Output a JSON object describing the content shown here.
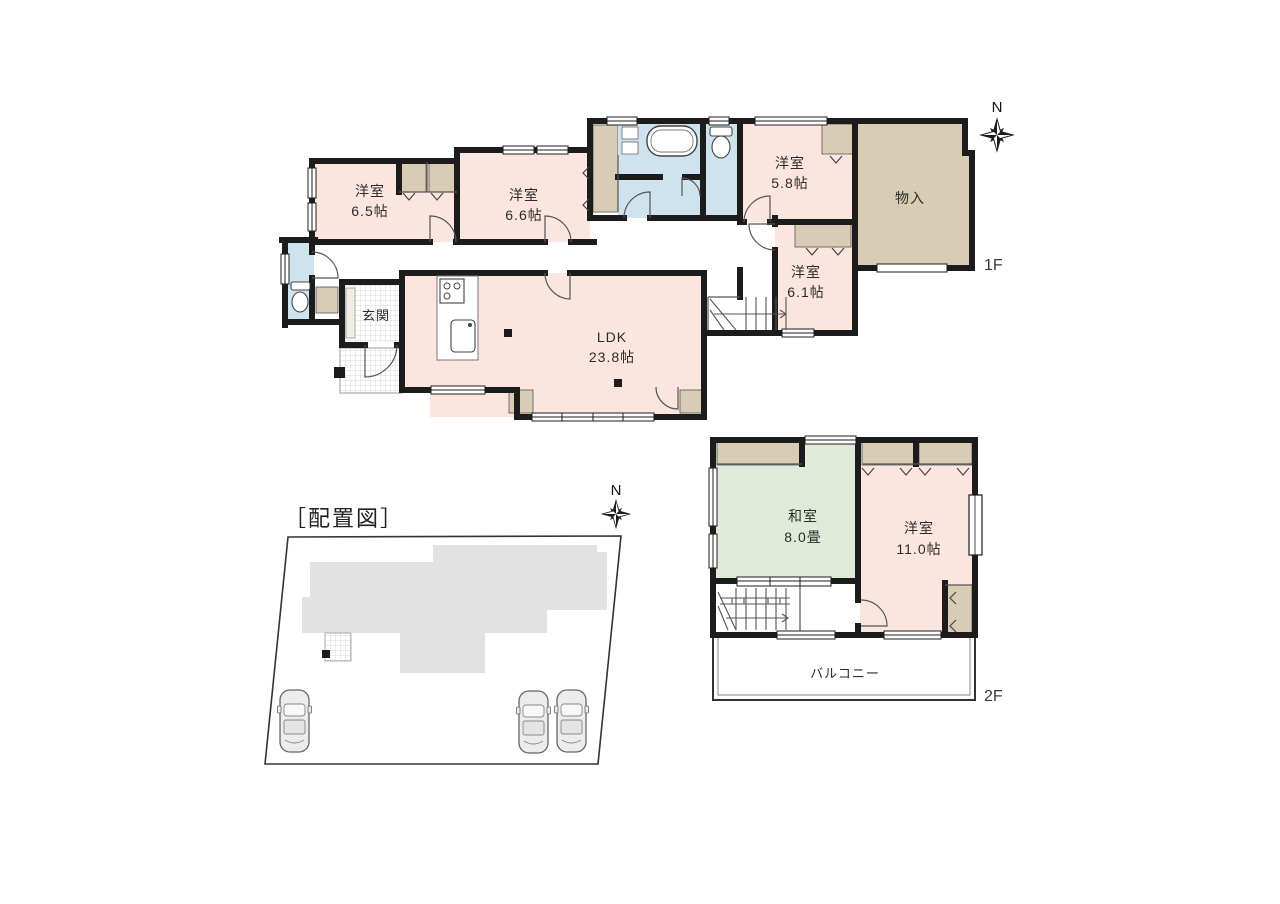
{
  "document": {
    "type": "madori-floorplan"
  },
  "colors": {
    "wall": "#1c1c1c",
    "room_pink": "#fbe5de",
    "closet_beige": "#d8ccb4",
    "wet_blue": "#cfe3ee",
    "tatami_green": "#e0ead9",
    "footprint_gray": "#e2e2e2"
  },
  "floor1": {
    "floor_label": "1F",
    "compass_label": "N",
    "rooms": {
      "yoshitsu_65": {
        "name": "洋室",
        "size": "6.5帖"
      },
      "yoshitsu_66": {
        "name": "洋室",
        "size": "6.6帖"
      },
      "yoshitsu_58": {
        "name": "洋室",
        "size": "5.8帖"
      },
      "yoshitsu_61": {
        "name": "洋室",
        "size": "6.1帖"
      },
      "monoire": {
        "name": "物入"
      },
      "genkan": {
        "name": "玄関"
      },
      "ldk": {
        "name": "LDK",
        "size": "23.8帖"
      }
    }
  },
  "floor2": {
    "floor_label": "2F",
    "rooms": {
      "washitsu": {
        "name": "和室",
        "size": "8.0畳"
      },
      "yoshitsu_110": {
        "name": "洋室",
        "size": "11.0帖"
      },
      "balcony": {
        "name": "バルコニー"
      }
    }
  },
  "site": {
    "title": "［配置図］",
    "compass_label": "N",
    "car_count": 3
  }
}
